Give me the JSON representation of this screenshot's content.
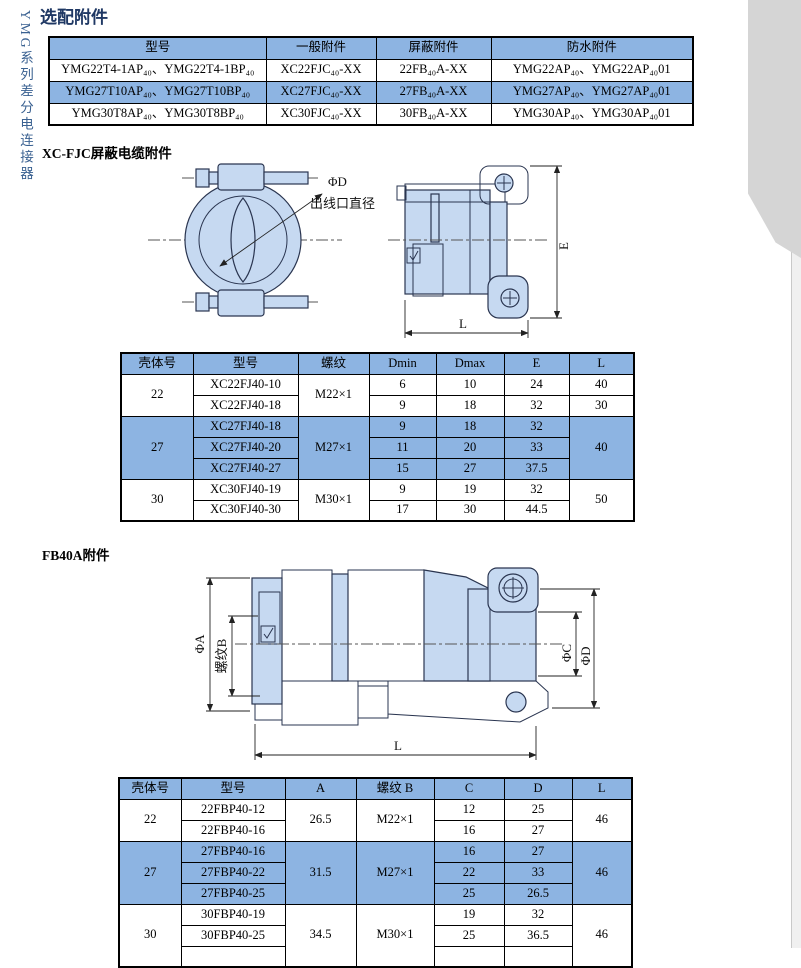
{
  "page_title": "选配附件",
  "side_tab": {
    "label": "YMG系列差分电连接器"
  },
  "colors": {
    "table_accent_blue": "#8DB4E2",
    "title_navy": "#1F3864",
    "drawing_fill": "#C6D9F1",
    "tab_gray": "#D5D5D5",
    "tab_text_blue": "#3A6191"
  },
  "accessory_table": {
    "headers": [
      "型号",
      "一般附件",
      "屏蔽附件",
      "防水附件"
    ],
    "rows": [
      {
        "model": "YMG22T4-1AP₄₀、YMG22T4-1BP₄₀",
        "general": "XC22FJC₄₀-XX",
        "shield": "22FB₄₀A-XX",
        "waterproof": "YMG22AP₄₀、YMG22AP₄₀01"
      },
      {
        "model": "YMG27T10AP₄₀、YMG27T10BP₄₀",
        "general": "XC27FJC₄₀-XX",
        "shield": "27FB₄₀A-XX",
        "waterproof": "YMG27AP₄₀、YMG27AP₄₀01"
      },
      {
        "model": "YMG30T8AP₄₀、YMG30T8BP₄₀",
        "general": "XC30FJC₄₀-XX",
        "shield": "30FB₄₀A-XX",
        "waterproof": "YMG30AP₄₀、YMG30AP₄₀01"
      }
    ]
  },
  "xcfjc": {
    "heading": "XC-FJC屏蔽电缆附件",
    "labels": {
      "phi_d": "ΦD",
      "phi_d_desc": "出线口直径",
      "e": "E",
      "l": "L"
    },
    "table": {
      "headers": [
        "壳体号",
        "型号",
        "螺纹",
        "Dmin",
        "Dmax",
        "E",
        "L"
      ],
      "g22": {
        "shell": "22",
        "thread": "M22×1",
        "r1": {
          "model": "XC22FJ40-10",
          "dmin": "6",
          "dmax": "10",
          "e": "24",
          "l": "40"
        },
        "r2": {
          "model": "XC22FJ40-18",
          "dmin": "9",
          "dmax": "18",
          "e": "32",
          "l": "30"
        }
      },
      "g27": {
        "shell": "27",
        "thread": "M27×1",
        "l": "40",
        "r1": {
          "model": "XC27FJ40-18",
          "dmin": "9",
          "dmax": "18",
          "e": "32"
        },
        "r2": {
          "model": "XC27FJ40-20",
          "dmin": "11",
          "dmax": "20",
          "e": "33"
        },
        "r3": {
          "model": "XC27FJ40-27",
          "dmin": "15",
          "dmax": "27",
          "e": "37.5"
        }
      },
      "g30": {
        "shell": "30",
        "thread": "M30×1",
        "l": "50",
        "r1": {
          "model": "XC30FJ40-19",
          "dmin": "9",
          "dmax": "19",
          "e": "32"
        },
        "r2": {
          "model": "XC30FJ40-30",
          "dmin": "17",
          "dmax": "30",
          "e": "44.5"
        }
      }
    }
  },
  "fb40a": {
    "heading": "FB40A附件",
    "labels": {
      "phi_a": "ΦA",
      "thread_b": "螺纹B",
      "phi_c": "ΦC",
      "phi_d": "ΦD",
      "l": "L"
    },
    "table": {
      "headers": [
        "壳体号",
        "型号",
        "A",
        "螺纹 B",
        "C",
        "D",
        "L"
      ],
      "g22": {
        "shell": "22",
        "a": "26.5",
        "thread": "M22×1",
        "l": "46",
        "r1": {
          "model": "22FBP40-12",
          "c": "12",
          "d": "25"
        },
        "r2": {
          "model": "22FBP40-16",
          "c": "16",
          "d": "27"
        }
      },
      "g27": {
        "shell": "27",
        "a": "31.5",
        "thread": "M27×1",
        "l": "46",
        "r1": {
          "model": "27FBP40-16",
          "c": "16",
          "d": "27"
        },
        "r2": {
          "model": "27FBP40-22",
          "c": "22",
          "d": "33"
        },
        "r3": {
          "model": "27FBP40-25",
          "c": "25",
          "d": "26.5"
        }
      },
      "g30": {
        "shell": "30",
        "a": "34.5",
        "thread": "M30×1",
        "l": "46",
        "r1": {
          "model": "30FBP40-19",
          "c": "19",
          "d": "32"
        },
        "r2": {
          "model": "30FBP40-25",
          "c": "25",
          "d": "36.5"
        },
        "r3": {
          "model": "",
          "c": "",
          "d": ""
        }
      }
    }
  }
}
